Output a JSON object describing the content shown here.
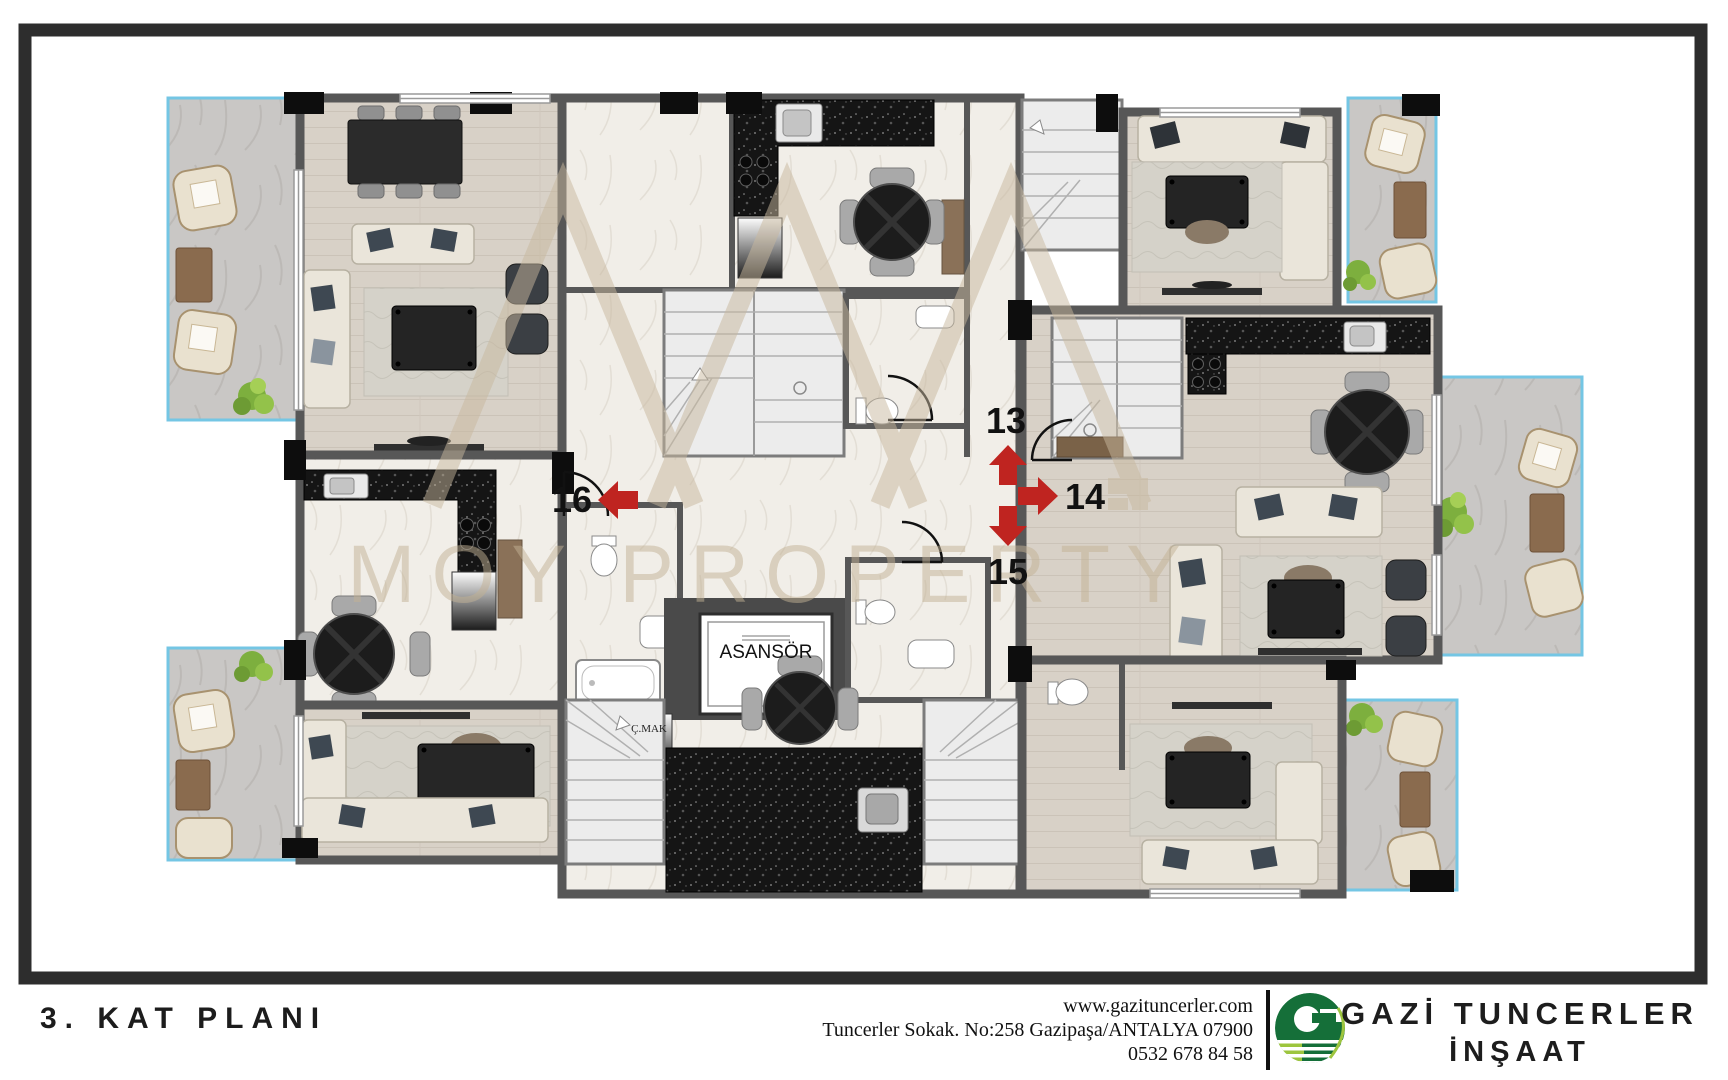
{
  "plan": {
    "floor_title": "3. KAT PLANI",
    "elevator_label": "ASANSÖR",
    "washer_label": "Ç.MAK",
    "units": {
      "left": {
        "number": "16",
        "direction": "left"
      },
      "top": {
        "number": "13",
        "direction": "up"
      },
      "right": {
        "number": "14",
        "direction": "right"
      },
      "bottom": {
        "number": "15",
        "direction": "down"
      }
    },
    "colors": {
      "arrow": "#bf2420",
      "walls": "#575757",
      "balcony_rail": "#74c6e4"
    }
  },
  "watermark": {
    "text": "MOY PROPERTY"
  },
  "footer": {
    "website": "www.gazituncerler.com",
    "address": "Tuncerler Sokak. No:258 Gazipaşa/ANTALYA 07900",
    "phone": "0532 678 84 58",
    "company_name": "GAZİ TUNCERLER",
    "company_suffix": "İNŞAAT",
    "logo_letter": "G",
    "logo_dark_green": "#156f39",
    "logo_light_green": "#9dc53e"
  }
}
